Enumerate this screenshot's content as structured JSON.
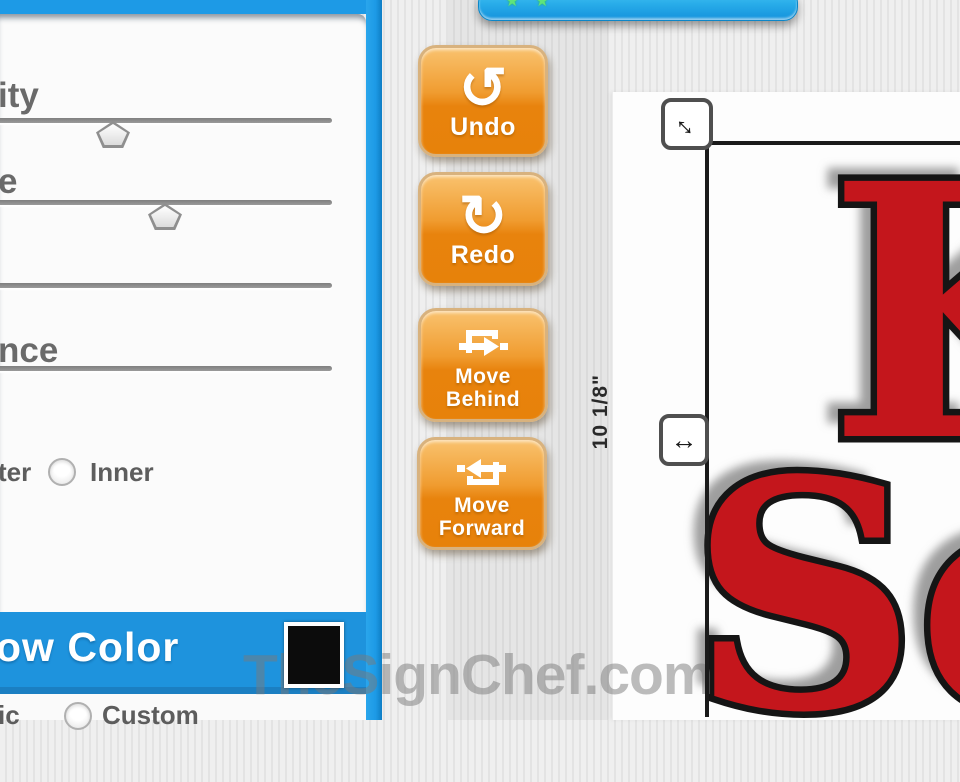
{
  "panel": {
    "slider1_label": "ity",
    "slider1_thumb_x": 96,
    "slider2_label": "e",
    "slider2_thumb_x": 148,
    "slider4_label": "nce",
    "radio_outer_label": "ter",
    "radio_inner_label": "Inner",
    "shadow_color_header": "ow Color",
    "swatch_color": "#0c0c0c",
    "radio_basic_label": "ic",
    "radio_custom_label": "Custom"
  },
  "toolbar": {
    "undo_label": "Undo",
    "undo_icon": "↺",
    "redo_label": "Redo",
    "redo_icon": "↻",
    "move_behind_label": "Move\nBehind",
    "move_forward_label": "Move\nForward"
  },
  "topbar": {
    "star_icon": "★"
  },
  "canvas": {
    "sign_line1": "K",
    "sign_line2": "Se",
    "sign_color": "#c4161c",
    "height_label": "10 1/8\"",
    "resize_diagonal_icon": "↔",
    "resize_horizontal_icon": "↔"
  },
  "watermark": "TheSignChef.com",
  "colors": {
    "accent_blue": "#1d9ae6",
    "button_orange": "#e8830d",
    "selection_black": "#1a1a1a",
    "background_gray": "#e9e9e9"
  }
}
